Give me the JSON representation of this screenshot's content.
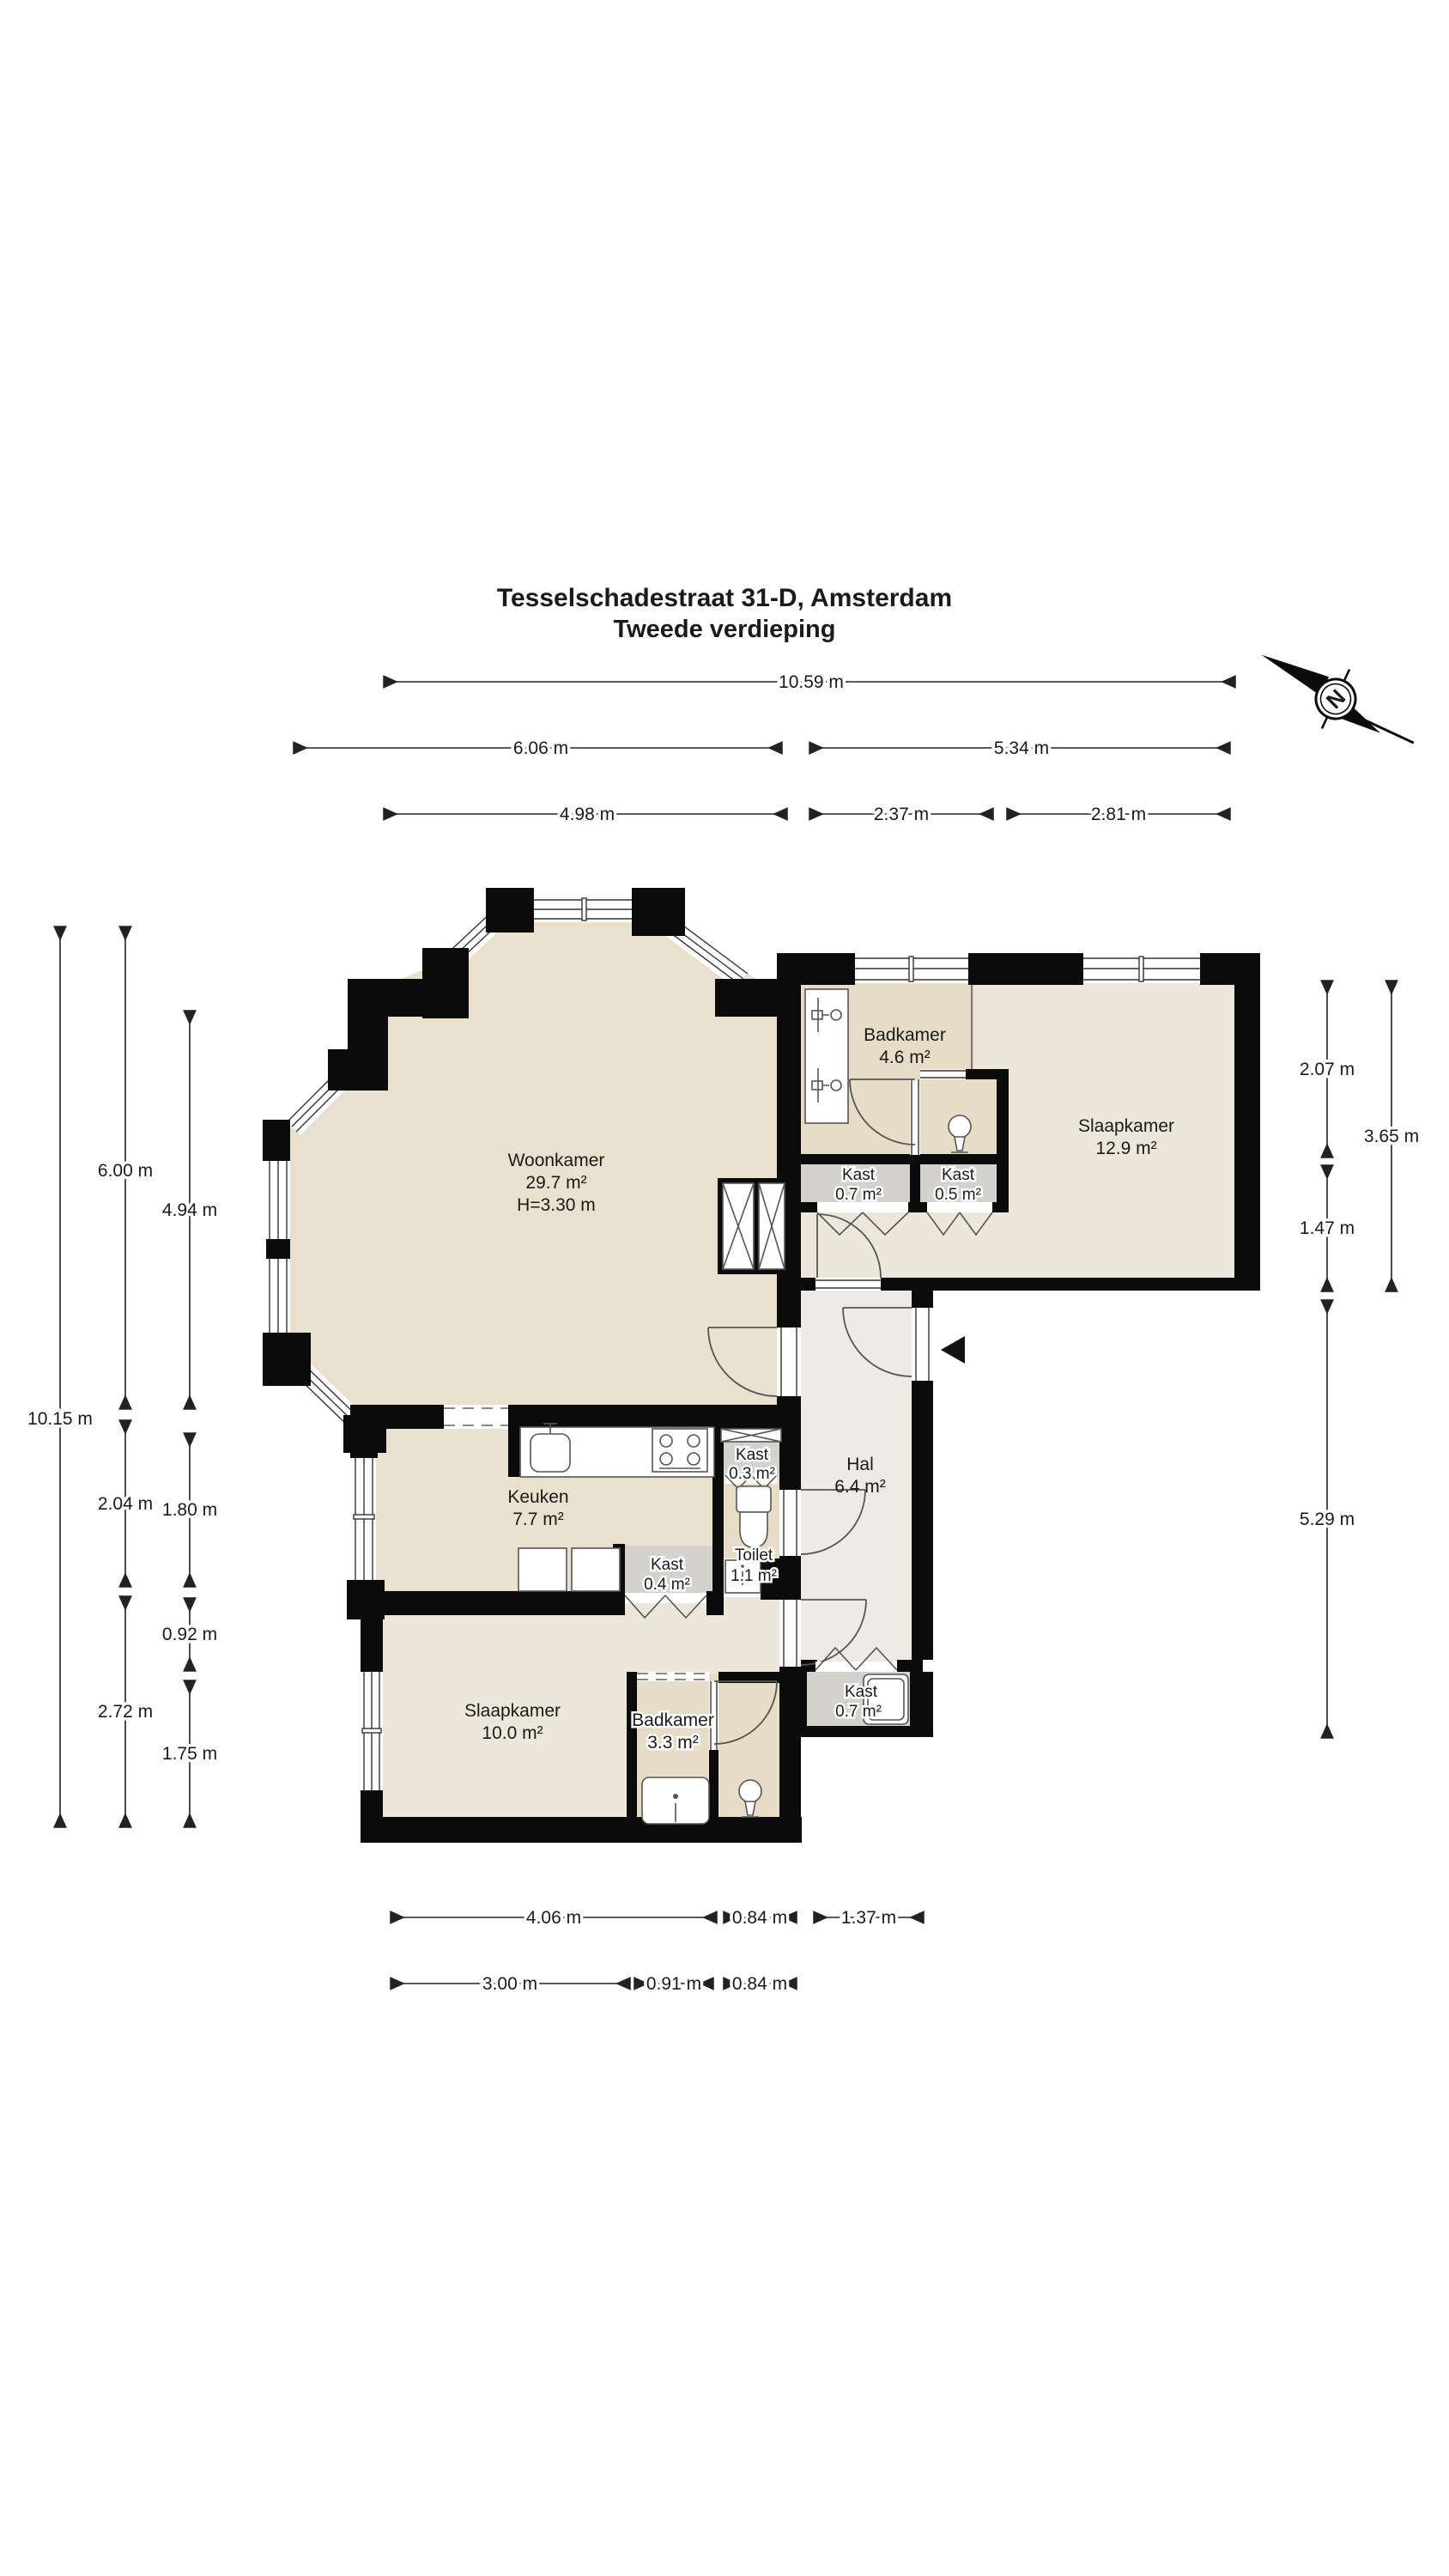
{
  "title": {
    "line1": "Tesselschadestraat 31-D, Amsterdam",
    "line2": "Tweede verdieping"
  },
  "compass": {
    "letter": "N"
  },
  "rooms": {
    "woonkamer": {
      "name": "Woonkamer",
      "area": "29.7 m²",
      "height": "H=3.30 m"
    },
    "badkamer1": {
      "name": "Badkamer",
      "area": "4.6 m²"
    },
    "slaapkamer1": {
      "name": "Slaapkamer",
      "area": "12.9 m²"
    },
    "kast1": {
      "name": "Kast",
      "area": "0.7 m²"
    },
    "kast2": {
      "name": "Kast",
      "area": "0.5 m²"
    },
    "keuken": {
      "name": "Keuken",
      "area": "7.7 m²"
    },
    "kast3": {
      "name": "Kast",
      "area": "0.3 m²"
    },
    "hal": {
      "name": "Hal",
      "area": "6.4 m²"
    },
    "toilet": {
      "name": "Toilet",
      "area": "1.1 m²"
    },
    "kast4": {
      "name": "Kast",
      "area": "0.4 m²"
    },
    "slaapkamer2": {
      "name": "Slaapkamer",
      "area": "10.0 m²"
    },
    "badkamer2": {
      "name": "Badkamer",
      "area": "3.3 m²"
    },
    "kast5": {
      "name": "Kast",
      "area": "0.7 m²"
    }
  },
  "dims": {
    "top": [
      "10.59 m",
      "6.06 m",
      "5.34 m",
      "4.98 m",
      "2.37 m",
      "2.81 m"
    ],
    "left": [
      "10.15 m",
      "6.00 m",
      "2.04 m",
      "2.72 m",
      "4.94 m",
      "1.80 m",
      "0.92 m",
      "1.75 m"
    ],
    "right": [
      "2.07 m",
      "1.47 m",
      "5.29 m",
      "3.65 m"
    ],
    "bottom": [
      "4.06 m",
      "0.84 m",
      "1.37 m",
      "3.00 m",
      "0.91 m",
      "0.84 m"
    ]
  },
  "colors": {
    "wall": "#0b0b0b",
    "living_fill": "#e9e0ce",
    "bath_fill": "#e7dcc6",
    "bedroom_fill": "#ece7db",
    "hall_fill": "#edebe4",
    "closet_fill": "#d3d2cc"
  }
}
